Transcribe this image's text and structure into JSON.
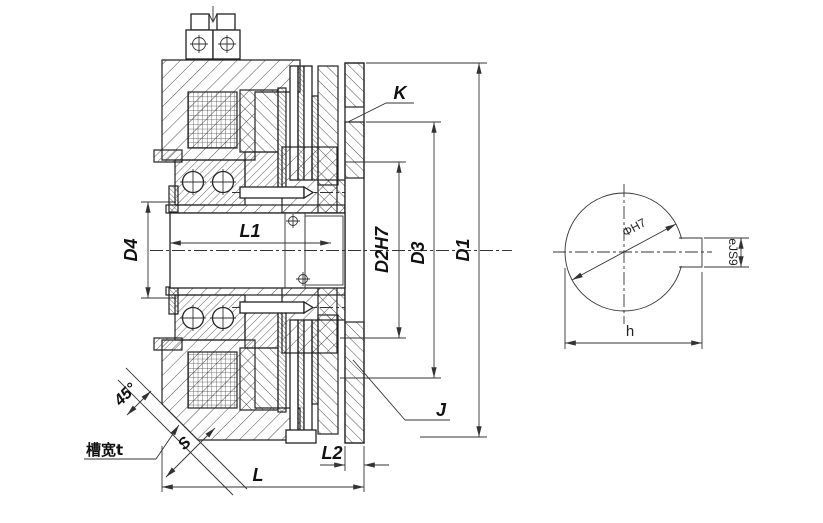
{
  "drawing": {
    "type": "electromagnetic-clutch-cross-section",
    "main_view": {
      "dimensions": {
        "d1": "D1",
        "d3": "D3",
        "d2": "D2H7",
        "d4": "D4",
        "l": "L",
        "l1": "L1",
        "l2": "L2",
        "k": "K",
        "j": "J",
        "s": "S",
        "chamfer_angle": "45°",
        "slot_width": "槽宽t"
      }
    },
    "side_view": {
      "dimensions": {
        "diameter": "ΦH7",
        "keyway_width": "eJS9",
        "keyway_span": "h"
      }
    },
    "colors": {
      "line": "#222222",
      "dim_line": "#333333",
      "background": "#ffffff",
      "text": "#111111"
    }
  }
}
